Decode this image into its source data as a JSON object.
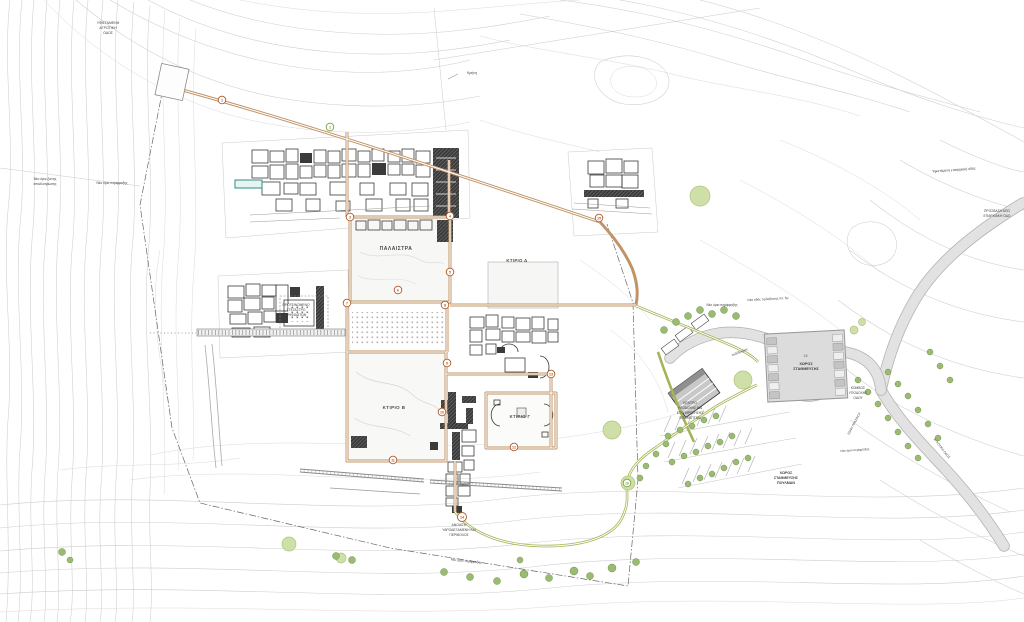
{
  "plan": {
    "site_labels": {
      "palaestra": "ΠΑΛΑΙΣΤΡΑ",
      "building_d": "ΚΤΙΡΙΟ Δ",
      "building_b": "ΚΤΙΡΙΟ Β",
      "building_c": "ΚΤΙΡΙΟ Γ",
      "mosaics_l1": "ΠΡΟΤΕΙΝΟΜΕΝΟ",
      "mosaics_l2": "ΣΤΕΓΑΣΤΡΟ",
      "mosaics_l3": "ΨΗΦΙΔΩΤΩΝ",
      "mosaics_vertical": "ΨΗΦΙΔΩΤΑ",
      "fountain": "Κρήνη",
      "south_l1": "ΑΝΟΙΧΤΗ",
      "south_l2": "ΥΔΡΟΔΕΞΑΜΕΝΗ ΚΑΙ",
      "south_l3": "ΠΕΡΙΒΟΛΟΣ"
    },
    "entrance_labels": {
      "parking_type": "Ι.Χ.",
      "parking_l1": "ΧΩΡΟΣ",
      "parking_l2": "ΣΤΑΘΜΕΥΣΗΣ",
      "bus_l1": "ΧΩΡΟΣ",
      "bus_l2": "ΣΤΑΘΜΕΥΣΗΣ",
      "bus_l3": "ΠΟΥΛΜΑΝ",
      "komvos_l1": "ΚΟΜΒΟΣ",
      "komvos_l2": "ΥΠΟΔΟΧΗΣ",
      "komvos_l3": "ΟΔΟΥ",
      "reception_l1": "ΚΕΝΤΡΟ",
      "reception_l2": "ΥΠΟΔΟΧΗΣ ΚΑΙ",
      "reception_l3": "ΕΞΥΠΗΡΕΤΗΣΗΣ",
      "reception_l4": "ΕΠΙΣΚΕΠΤΩΝ",
      "green_zone": "ΖΩΝΗ ΠΡΑΣΙΝΟΥ",
      "footpath": "πεζόδρομος"
    },
    "road_labels": {
      "top_left_l1": "ΥΦΙΣΤΑΜΕΝΗ",
      "top_left_l2": "ΑΓΡΟΤΙΚΗ",
      "top_left_l3": "ΟΔΟΣ",
      "existing_road": "Υφιστάμενη επαρχιακή οδός",
      "access_l1": "ΠΡΟΣΒΑΣΗ ΑΠΟ",
      "access_l2": "ΕΠΑΡΧΙΑΚΗ ΟΔΟ",
      "rural_road": "ΑΓΡΟΤΙΚΗ ΟΔΟΣ",
      "new_access": "Νέα οδός πρόσβασης πλ. 5μ"
    },
    "boundary_labels": {
      "fence_left": "Νέο όριο περίφραξης",
      "expropriation_l1": "Νέο όριο ζώνης",
      "expropriation_l2": "απαλλοτρίωσης",
      "fence_mid": "Νέο όριο περίφραξης",
      "fence_right": "Νέο όριο περίφραξης",
      "fence_bottom": "Νέο όριο περίφραξης"
    },
    "route_nodes": [
      {
        "n": "1"
      },
      {
        "n": "2"
      },
      {
        "n": "3"
      },
      {
        "n": "4"
      },
      {
        "n": "5"
      },
      {
        "n": "6"
      },
      {
        "n": "7"
      },
      {
        "n": "8"
      },
      {
        "n": "9"
      },
      {
        "n": "10"
      },
      {
        "n": "11"
      },
      {
        "n": "12"
      },
      {
        "n": "13"
      },
      {
        "n": "14"
      },
      {
        "n": "15"
      },
      {
        "n": "16"
      }
    ],
    "colors": {
      "walkway_tan": "#c09468",
      "footpath_green": "#a4b456",
      "road_fill": "#e2e2e2",
      "road_edge": "#b0b0b0",
      "tree_green": "#9cbb72",
      "tree_light": "#cfdfa8",
      "pool_teal": "#2a8f86",
      "contour_gray": "#cdcdcd",
      "ruins_dark": "#3b3b3b",
      "node_ring": "#b05a28"
    }
  }
}
